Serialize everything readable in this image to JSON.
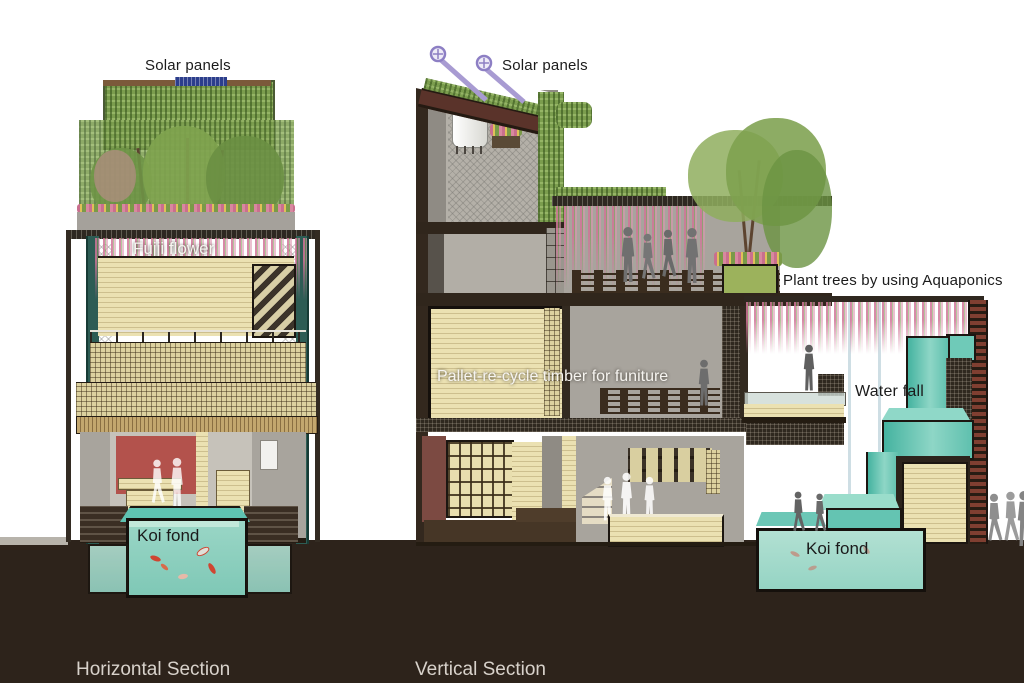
{
  "horizontal_section": {
    "title": "Horizontal Section",
    "labels": {
      "solar_panels": "Solar panels",
      "fujji_flower": "Fujji flower",
      "koi_pond": "Koi fond"
    }
  },
  "vertical_section": {
    "title": "Vertical Section",
    "labels": {
      "solar_panels": "Solar panels",
      "plant_trees": "Plant trees by using Aquaponics",
      "pallet_timber": "Pallet-re-cycle timber for funiture",
      "water_fall": "Water fall",
      "koi_pond": "Koi fond"
    }
  },
  "palette": {
    "background": "#ffffff",
    "ground": "#2d231b",
    "water_teal": "#7fc8b6",
    "timber_cream": "#e6dcab",
    "concrete_gray": "#a8a49d",
    "column_teal": "#2d5c54",
    "wall_red": "#b3524c",
    "wall_maroon": "#7c4a42",
    "vine_green": "#7b9d4e",
    "fuji_pink": "#d076a0",
    "solar_panel_blue": "#2c3e8c",
    "solar_tube_lavender": "#a89bd2",
    "roof_maroon": "#5a332a",
    "title_text": "#d8d2cb"
  }
}
